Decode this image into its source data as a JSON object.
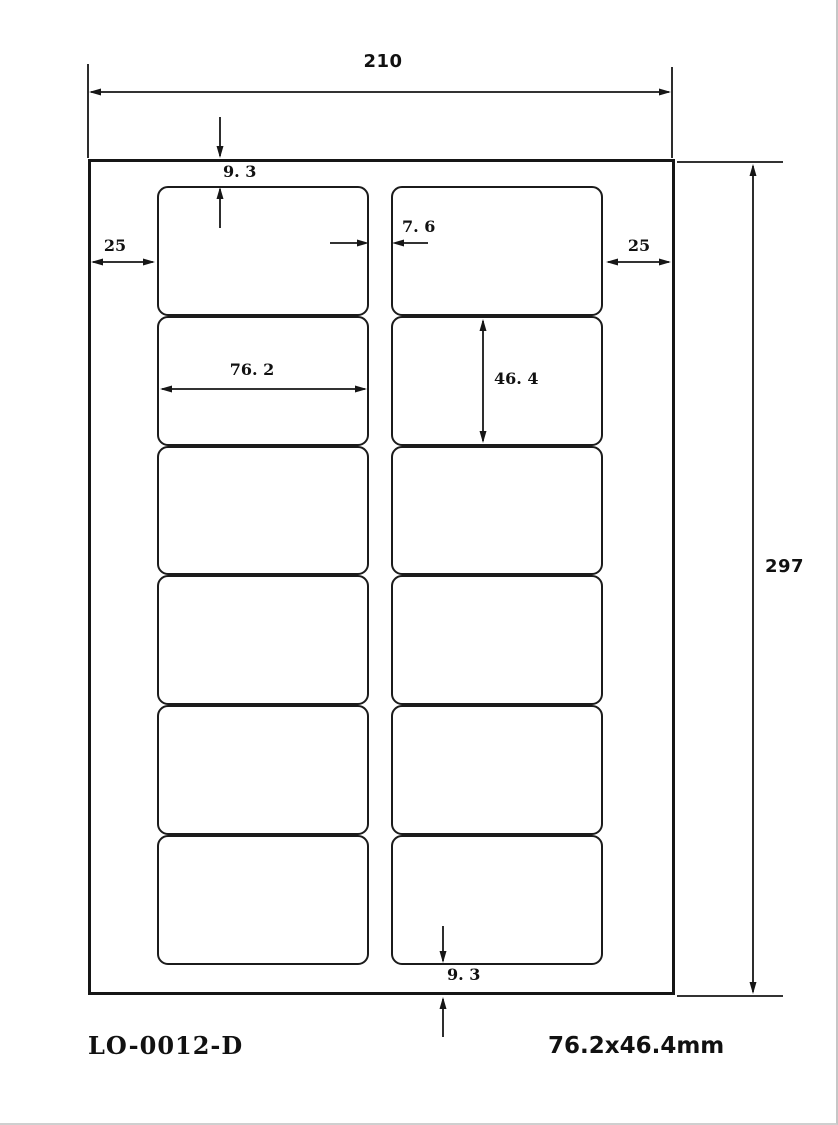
{
  "title_block": {
    "part_number": "LO-0012-D",
    "label_size": "76.2x46.4mm"
  },
  "dimensions": {
    "sheet_width": "210",
    "sheet_height": "297",
    "top_margin": "9. 3",
    "bottom_margin": "9. 3",
    "left_margin": "25",
    "right_margin": "25",
    "column_gap": "7. 6",
    "label_width": "76. 2",
    "label_height": "46. 4"
  },
  "sheet": {
    "rows": 6,
    "columns": 2
  },
  "colors": {
    "line": "#161616",
    "background": "#ffffff"
  }
}
